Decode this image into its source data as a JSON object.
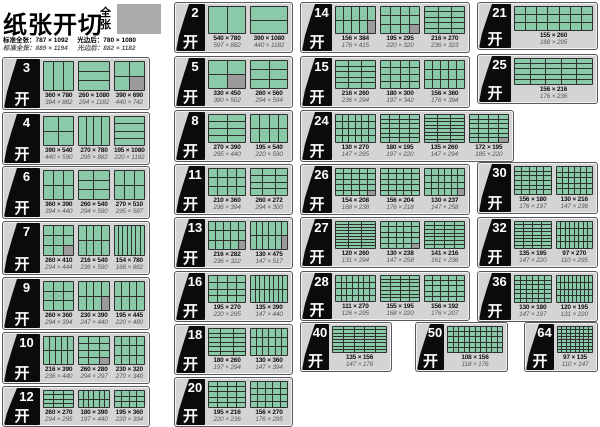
{
  "kai": "开",
  "header": {
    "title": "纸张开切",
    "full_sheet_label": "全张",
    "spec_standard_1": "标准全张：787 × 1092",
    "spec_standard_2": "标准全张：889 × 1194",
    "spec_trimmed_1": "光边后：780 × 1080",
    "spec_trimmed_2": "光边后：882 × 1182"
  },
  "colors": {
    "piece_green": "#8bcaa8",
    "waste_gray": "#9b9b9b",
    "panel_gray": "#d4d4d4",
    "flag_black": "#0b0b0b",
    "swatch_gray": "#ababab"
  },
  "panels": [
    {
      "num": "3",
      "x": 2,
      "y": 57,
      "w": 148,
      "h": 53,
      "fw": 36,
      "layouts": [
        {
          "size": "360 × 780",
          "size_large": "394 × 882",
          "cols": 3,
          "rows": 1,
          "waste": false
        },
        {
          "size": "260 × 1080",
          "size_large": "294 × 1182",
          "cols": 1,
          "rows": 3,
          "waste": false
        },
        {
          "size": "390 × 690",
          "size_large": "440 × 742",
          "cols": 2,
          "rows": 2,
          "waste": true
        }
      ]
    },
    {
      "num": "4",
      "x": 2,
      "y": 112,
      "w": 148,
      "h": 53,
      "fw": 36,
      "layouts": [
        {
          "size": "390 × 540",
          "size_large": "440 × 590",
          "cols": 2,
          "rows": 2,
          "waste": false
        },
        {
          "size": "270 × 780",
          "size_large": "295 × 882",
          "cols": 4,
          "rows": 1,
          "waste": false
        },
        {
          "size": "195 × 1080",
          "size_large": "220 × 1182",
          "cols": 1,
          "rows": 4,
          "waste": false
        }
      ]
    },
    {
      "num": "6",
      "x": 2,
      "y": 166,
      "w": 148,
      "h": 53,
      "fw": 36,
      "layouts": [
        {
          "size": "360 × 390",
          "size_large": "394 × 440",
          "cols": 3,
          "rows": 2,
          "waste": false
        },
        {
          "size": "260 × 540",
          "size_large": "294 × 590",
          "cols": 2,
          "rows": 3,
          "waste": false
        },
        {
          "size": "270 × 510",
          "size_large": "295 × 587",
          "cols": 3,
          "rows": 2,
          "waste": false
        }
      ]
    },
    {
      "num": "7",
      "x": 2,
      "y": 221,
      "w": 148,
      "h": 54,
      "fw": 36,
      "layouts": [
        {
          "size": "260 × 410",
          "size_large": "294 × 444",
          "cols": 3,
          "rows": 3,
          "waste": true
        },
        {
          "size": "216 × 540",
          "size_large": "236 × 590",
          "cols": 4,
          "rows": 2,
          "waste": false
        },
        {
          "size": "154 × 780",
          "size_large": "168 × 882",
          "cols": 7,
          "rows": 1,
          "waste": false
        }
      ]
    },
    {
      "num": "9",
      "x": 2,
      "y": 277,
      "w": 148,
      "h": 53,
      "fw": 36,
      "layouts": [
        {
          "size": "260 × 360",
          "size_large": "294 × 394",
          "cols": 3,
          "rows": 3,
          "waste": false
        },
        {
          "size": "230 × 390",
          "size_large": "247 × 440",
          "cols": 4,
          "rows": 2,
          "waste": true
        },
        {
          "size": "195 × 445",
          "size_large": "220 × 480",
          "cols": 4,
          "rows": 2,
          "waste": false
        }
      ]
    },
    {
      "num": "10",
      "x": 2,
      "y": 332,
      "w": 148,
      "h": 52,
      "fw": 36,
      "layouts": [
        {
          "size": "216 × 390",
          "size_large": "236 × 440",
          "cols": 5,
          "rows": 2,
          "waste": false
        },
        {
          "size": "260 × 280",
          "size_large": "294 × 297",
          "cols": 3,
          "rows": 4,
          "waste": true
        },
        {
          "size": "230 × 320",
          "size_large": "270 × 340",
          "cols": 4,
          "rows": 3,
          "waste": false
        }
      ]
    },
    {
      "num": "12",
      "x": 2,
      "y": 386,
      "w": 148,
      "h": 41,
      "fw": 36,
      "layouts": [
        {
          "size": "260 × 270",
          "size_large": "294 × 295",
          "cols": 3,
          "rows": 4,
          "waste": false
        },
        {
          "size": "180 × 390",
          "size_large": "197 × 440",
          "cols": 6,
          "rows": 2,
          "waste": false
        },
        {
          "size": "195 × 360",
          "size_large": "220 × 394",
          "cols": 4,
          "rows": 3,
          "waste": false
        }
      ]
    },
    {
      "num": "2",
      "x": 174,
      "y": 2,
      "w": 119,
      "h": 51,
      "fw": 29,
      "layouts": [
        {
          "size": "540 × 780",
          "size_large": "597 × 882",
          "cols": 2,
          "rows": 1,
          "waste": false
        },
        {
          "size": "390 × 1080",
          "size_large": "440 × 1182",
          "cols": 1,
          "rows": 2,
          "waste": false
        }
      ]
    },
    {
      "num": "5",
      "x": 174,
      "y": 56,
      "w": 119,
      "h": 52,
      "fw": 29,
      "layouts": [
        {
          "size": "330 × 450",
          "size_large": "380 × 502",
          "cols": 2,
          "rows": 2,
          "waste": true
        },
        {
          "size": "260 × 560",
          "size_large": "294 × 594",
          "cols": 2,
          "rows": 3,
          "waste": false
        }
      ]
    },
    {
      "num": "8",
      "x": 174,
      "y": 110,
      "w": 119,
      "h": 52,
      "fw": 29,
      "layouts": [
        {
          "size": "270 × 390",
          "size_large": "295 × 440",
          "cols": 2,
          "rows": 4,
          "waste": false
        },
        {
          "size": "195 × 540",
          "size_large": "220 × 590",
          "cols": 4,
          "rows": 2,
          "waste": false
        }
      ]
    },
    {
      "num": "11",
      "x": 174,
      "y": 164,
      "w": 119,
      "h": 51,
      "fw": 29,
      "layouts": [
        {
          "size": "210 × 360",
          "size_large": "236 × 394",
          "cols": 4,
          "rows": 3,
          "waste": false
        },
        {
          "size": "260 × 272",
          "size_large": "294 × 300",
          "cols": 3,
          "rows": 4,
          "waste": false
        }
      ]
    },
    {
      "num": "13",
      "x": 174,
      "y": 217,
      "w": 119,
      "h": 52,
      "fw": 29,
      "layouts": [
        {
          "size": "216 × 282",
          "size_large": "236 × 322",
          "cols": 5,
          "rows": 3,
          "waste": true
        },
        {
          "size": "130 × 475",
          "size_large": "147 × 517",
          "cols": 6,
          "rows": 2,
          "waste": true
        }
      ]
    },
    {
      "num": "16",
      "x": 174,
      "y": 271,
      "w": 119,
      "h": 51,
      "fw": 29,
      "layouts": [
        {
          "size": "195 × 270",
          "size_large": "220 × 295",
          "cols": 4,
          "rows": 4,
          "waste": false
        },
        {
          "size": "135 × 390",
          "size_large": "147 × 440",
          "cols": 8,
          "rows": 2,
          "waste": false
        }
      ]
    },
    {
      "num": "18",
      "x": 174,
      "y": 324,
      "w": 119,
      "h": 51,
      "fw": 29,
      "layouts": [
        {
          "size": "180 × 260",
          "size_large": "197 × 294",
          "cols": 3,
          "rows": 6,
          "waste": false
        },
        {
          "size": "130 × 360",
          "size_large": "147 × 394",
          "cols": 6,
          "rows": 3,
          "waste": false
        }
      ]
    },
    {
      "num": "20",
      "x": 174,
      "y": 377,
      "w": 119,
      "h": 50,
      "fw": 29,
      "layouts": [
        {
          "size": "195 × 216",
          "size_large": "220 × 236",
          "cols": 4,
          "rows": 5,
          "waste": false
        },
        {
          "size": "156 × 270",
          "size_large": "176 × 295",
          "cols": 5,
          "rows": 4,
          "waste": false
        }
      ]
    },
    {
      "num": "14",
      "x": 300,
      "y": 2,
      "w": 170,
      "h": 51,
      "fw": 30,
      "layouts": [
        {
          "size": "156 × 384",
          "size_large": "176 × 415",
          "cols": 5,
          "rows": 2,
          "waste": true
        },
        {
          "size": "195 × 295",
          "size_large": "220 × 320",
          "cols": 4,
          "rows": 3,
          "waste": true
        },
        {
          "size": "216 × 270",
          "size_large": "236 × 323",
          "cols": 3,
          "rows": 5,
          "waste": false
        }
      ]
    },
    {
      "num": "15",
      "x": 300,
      "y": 56,
      "w": 170,
      "h": 52,
      "fw": 30,
      "layouts": [
        {
          "size": "216 × 260",
          "size_large": "236 × 294",
          "cols": 3,
          "rows": 5,
          "waste": false
        },
        {
          "size": "180 × 300",
          "size_large": "197 × 342",
          "cols": 4,
          "rows": 4,
          "waste": false
        },
        {
          "size": "156 × 360",
          "size_large": "176 × 394",
          "cols": 5,
          "rows": 3,
          "waste": false
        }
      ]
    },
    {
      "num": "24",
      "x": 300,
      "y": 110,
      "w": 214,
      "h": 52,
      "fw": 30,
      "layouts": [
        {
          "size": "130 × 270",
          "size_large": "147 × 295",
          "cols": 6,
          "rows": 4,
          "waste": false
        },
        {
          "size": "180 × 195",
          "size_large": "197 × 220",
          "cols": 4,
          "rows": 6,
          "waste": false
        },
        {
          "size": "135 × 260",
          "size_large": "147 × 294",
          "cols": 3,
          "rows": 8,
          "waste": false
        },
        {
          "size": "172 × 195",
          "size_large": "185 × 220",
          "cols": 4,
          "rows": 6,
          "waste": true
        }
      ]
    },
    {
      "num": "26",
      "x": 300,
      "y": 164,
      "w": 170,
      "h": 51,
      "fw": 30,
      "layouts": [
        {
          "size": "154 × 208",
          "size_large": "168 × 238",
          "cols": 5,
          "rows": 5,
          "waste": true
        },
        {
          "size": "156 × 204",
          "size_large": "176 × 218",
          "cols": 5,
          "rows": 5,
          "waste": false
        },
        {
          "size": "130 × 237",
          "size_large": "147 × 258",
          "cols": 6,
          "rows": 4,
          "waste": true
        }
      ]
    },
    {
      "num": "27",
      "x": 300,
      "y": 217,
      "w": 170,
      "h": 51,
      "fw": 30,
      "layouts": [
        {
          "size": "120 × 260",
          "size_large": "131 × 294",
          "cols": 3,
          "rows": 9,
          "waste": false
        },
        {
          "size": "130 × 238",
          "size_large": "147 × 258",
          "cols": 5,
          "rows": 5,
          "waste": true
        },
        {
          "size": "141 × 216",
          "size_large": "161 × 236",
          "cols": 4,
          "rows": 7,
          "waste": false
        }
      ]
    },
    {
      "num": "28",
      "x": 300,
      "y": 271,
      "w": 170,
      "h": 50,
      "fw": 30,
      "layouts": [
        {
          "size": "111 × 270",
          "size_large": "126 × 295",
          "cols": 7,
          "rows": 4,
          "waste": false
        },
        {
          "size": "155 × 195",
          "size_large": "168 × 220",
          "cols": 4,
          "rows": 7,
          "waste": false
        },
        {
          "size": "156 × 192",
          "size_large": "176 × 207",
          "cols": 5,
          "rows": 5,
          "waste": false
        }
      ]
    },
    {
      "num": "40",
      "x": 300,
      "y": 322,
      "w": 92,
      "h": 50,
      "fw": 27,
      "layouts": [
        {
          "size": "135 × 156",
          "size_large": "147 × 176",
          "cols": 5,
          "rows": 8,
          "waste": false
        }
      ]
    },
    {
      "num": "50",
      "x": 415,
      "y": 322,
      "w": 93,
      "h": 50,
      "fw": 27,
      "layouts": [
        {
          "size": "108 × 156",
          "size_large": "118 × 176",
          "cols": 10,
          "rows": 5,
          "waste": false
        }
      ]
    },
    {
      "num": "21",
      "x": 477,
      "y": 2,
      "w": 121,
      "h": 48,
      "fw": 32,
      "layouts": [
        {
          "size": "155 × 260",
          "size_large": "168 × 295",
          "cols": 7,
          "rows": 3,
          "waste": false
        }
      ]
    },
    {
      "num": "25",
      "x": 477,
      "y": 54,
      "w": 121,
      "h": 50,
      "fw": 32,
      "layouts": [
        {
          "size": "156 × 216",
          "size_large": "176 × 236",
          "cols": 5,
          "rows": 5,
          "waste": false
        }
      ]
    },
    {
      "num": "30",
      "x": 477,
      "y": 162,
      "w": 121,
      "h": 52,
      "fw": 32,
      "layouts": [
        {
          "size": "156 × 180",
          "size_large": "176 × 197",
          "cols": 5,
          "rows": 6,
          "waste": false
        },
        {
          "size": "130 × 216",
          "size_large": "147 × 236",
          "cols": 6,
          "rows": 5,
          "waste": false
        }
      ]
    },
    {
      "num": "32",
      "x": 477,
      "y": 217,
      "w": 121,
      "h": 51,
      "fw": 32,
      "layouts": [
        {
          "size": "135 × 195",
          "size_large": "147 × 220",
          "cols": 4,
          "rows": 8,
          "waste": false
        },
        {
          "size": "97 × 270",
          "size_large": "110 × 295",
          "cols": 8,
          "rows": 4,
          "waste": false
        }
      ]
    },
    {
      "num": "36",
      "x": 477,
      "y": 271,
      "w": 121,
      "h": 51,
      "fw": 32,
      "layouts": [
        {
          "size": "130 × 180",
          "size_large": "147 × 197",
          "cols": 6,
          "rows": 6,
          "waste": false
        },
        {
          "size": "120 × 195",
          "size_large": "131 × 220",
          "cols": 9,
          "rows": 4,
          "waste": false
        }
      ]
    },
    {
      "num": "64",
      "x": 524,
      "y": 322,
      "w": 74,
      "h": 50,
      "fw": 28,
      "layouts": [
        {
          "size": "97 × 135",
          "size_large": "110 × 147",
          "cols": 8,
          "rows": 8,
          "waste": false
        }
      ]
    }
  ]
}
